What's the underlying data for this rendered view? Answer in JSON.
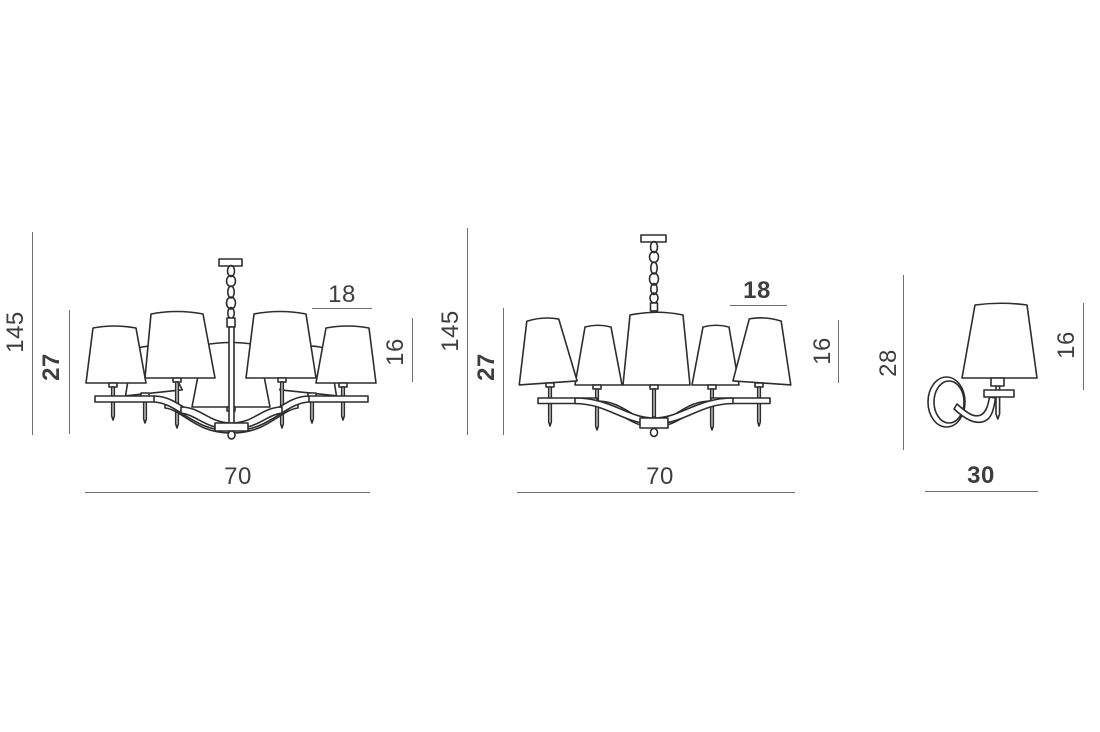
{
  "page": {
    "background": "#ffffff",
    "drawing_line_color": "#2d2d2d",
    "dimension_line_color": "#6f6f6f",
    "label_color": "#3e3e3e"
  },
  "figures": [
    {
      "name": "chandelier-8-light",
      "dimensions": {
        "overall_height": "145",
        "body_height": "27",
        "shade_diameter": "18",
        "shade_height": "16",
        "overall_width": "70"
      }
    },
    {
      "name": "chandelier-5-light",
      "dimensions": {
        "overall_height": "145",
        "body_height": "27",
        "shade_diameter": "18",
        "shade_height": "16",
        "overall_width": "70"
      }
    },
    {
      "name": "wall-sconce",
      "dimensions": {
        "overall_height": "28",
        "shade_height": "16",
        "overall_width": "30"
      }
    }
  ]
}
